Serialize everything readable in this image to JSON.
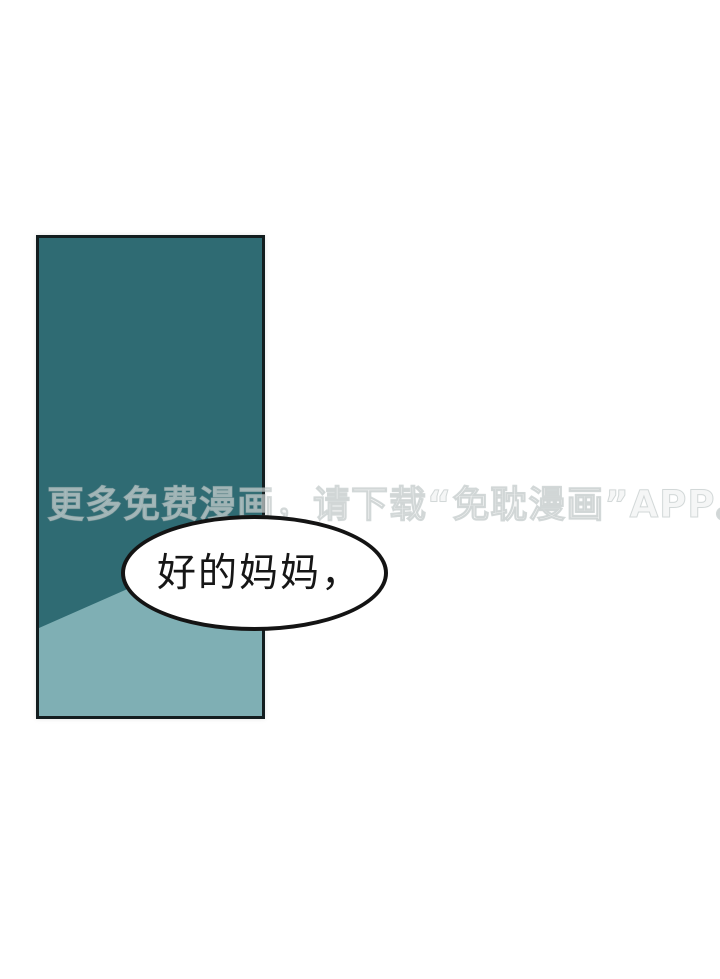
{
  "page": {
    "background_color": "#ffffff"
  },
  "panel": {
    "dark_color": "#2f6b73",
    "light_color": "#7fafb4",
    "border_color": "#131d1f"
  },
  "watermark": {
    "text": "更多免费漫画，请下载“免耽漫画”APP。"
  },
  "bubble": {
    "text": "好的妈妈，",
    "fill_color": "#ffffff",
    "border_color": "#141414"
  }
}
